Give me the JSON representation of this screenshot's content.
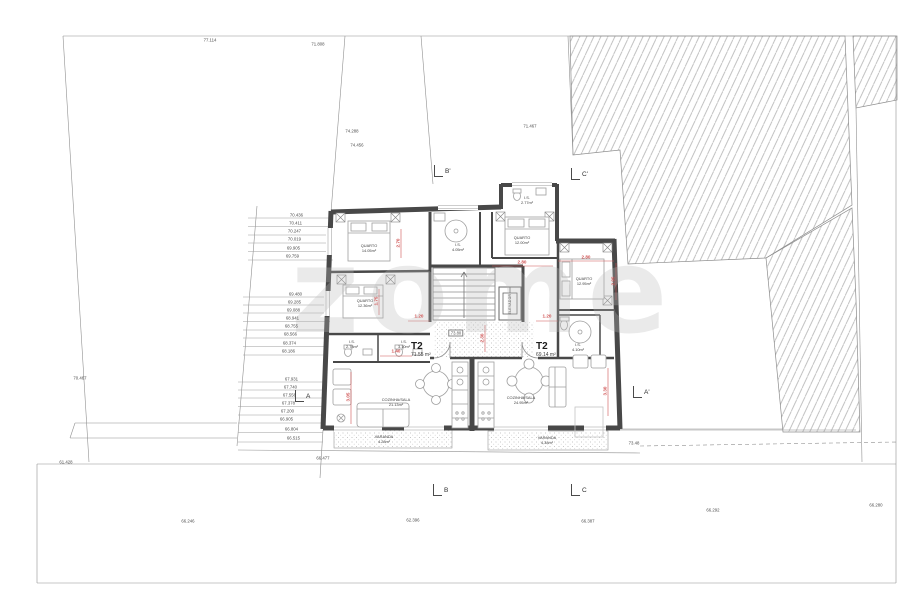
{
  "watermark": "zome",
  "apartments": {
    "left": {
      "type": "T2",
      "area": "71.55 m²",
      "rooms": [
        {
          "name": "QUARTO",
          "area": "14.05m²"
        },
        {
          "name": "QUARTO",
          "area": "12.36m²"
        },
        {
          "name": "I.S.",
          "area": "4.05m²"
        },
        {
          "name": "I.S.",
          "area": "2.78m²"
        },
        {
          "name": "I.S.",
          "area": "3.10m²"
        },
        {
          "name": "COZINHA/SALA",
          "area": "21.13m²"
        },
        {
          "name": "VARANDA",
          "area": "4.28m²"
        }
      ]
    },
    "right": {
      "type": "T2",
      "area": "69.14 m²",
      "rooms": [
        {
          "name": "QUARTO",
          "area": "12.00m²"
        },
        {
          "name": "QUARTO",
          "area": "12.95m²"
        },
        {
          "name": "I.S.",
          "area": "2.77m²"
        },
        {
          "name": "I.S.",
          "area": "4.10m²"
        },
        {
          "name": "COZINHA/SALA",
          "area": "24.95m²"
        },
        {
          "name": "VARANDA",
          "area": "4.38m²"
        }
      ]
    }
  },
  "core": {
    "elevator": "ELEVADOR",
    "hall_level": "73.80"
  },
  "section_markers": [
    {
      "label": "B'",
      "x": 434,
      "y": 165
    },
    {
      "label": "C'",
      "x": 571,
      "y": 168
    },
    {
      "label": "A",
      "x": 295,
      "y": 390
    },
    {
      "label": "A'",
      "x": 633,
      "y": 386
    },
    {
      "label": "B",
      "x": 433,
      "y": 484
    },
    {
      "label": "C",
      "x": 571,
      "y": 484
    }
  ],
  "elevation_labels": [
    {
      "x": 303,
      "y": 215,
      "t": "70.436",
      "r": 1
    },
    {
      "x": 302,
      "y": 223,
      "t": "70.411",
      "r": 1
    },
    {
      "x": 301,
      "y": 231,
      "t": "70.247",
      "r": 1
    },
    {
      "x": 301,
      "y": 239,
      "t": "70.019",
      "r": 1
    },
    {
      "x": 300,
      "y": 248,
      "t": "69.905",
      "r": 1
    },
    {
      "x": 299,
      "y": 256,
      "t": "69.759",
      "r": 1
    },
    {
      "x": 302,
      "y": 294,
      "t": "69.480",
      "r": 1
    },
    {
      "x": 301,
      "y": 302,
      "t": "69.285",
      "r": 1
    },
    {
      "x": 300,
      "y": 310,
      "t": "69.088",
      "r": 1
    },
    {
      "x": 299,
      "y": 318,
      "t": "68.941",
      "r": 1
    },
    {
      "x": 298,
      "y": 326,
      "t": "68.755",
      "r": 1
    },
    {
      "x": 297,
      "y": 334,
      "t": "68.566",
      "r": 1
    },
    {
      "x": 296,
      "y": 343,
      "t": "68.374",
      "r": 1
    },
    {
      "x": 295,
      "y": 351,
      "t": "68.186",
      "r": 1
    },
    {
      "x": 298,
      "y": 379,
      "t": "67.931",
      "r": 1
    },
    {
      "x": 297,
      "y": 387,
      "t": "67.740",
      "r": 1
    },
    {
      "x": 296,
      "y": 395,
      "t": "67.556",
      "r": 1
    },
    {
      "x": 295,
      "y": 403,
      "t": "67.378",
      "r": 1
    },
    {
      "x": 294,
      "y": 411,
      "t": "67.200",
      "r": 1
    },
    {
      "x": 293,
      "y": 419,
      "t": "66.905",
      "r": 1
    },
    {
      "x": 298,
      "y": 429,
      "t": "66.804",
      "r": 1
    },
    {
      "x": 300,
      "y": 438,
      "t": "66.515",
      "r": 1
    },
    {
      "x": 210,
      "y": 40,
      "t": "77.114"
    },
    {
      "x": 318,
      "y": 44,
      "t": "71.808"
    },
    {
      "x": 352,
      "y": 131,
      "t": "74.288"
    },
    {
      "x": 357,
      "y": 145,
      "t": "74.456"
    },
    {
      "x": 530,
      "y": 126,
      "t": "71.467"
    },
    {
      "x": 80,
      "y": 378,
      "t": "70.467"
    },
    {
      "x": 323,
      "y": 458,
      "t": "66.477"
    },
    {
      "x": 66,
      "y": 462,
      "t": "61.428"
    },
    {
      "x": 188,
      "y": 521,
      "t": "66.246"
    },
    {
      "x": 413,
      "y": 520,
      "t": "62.396"
    },
    {
      "x": 588,
      "y": 521,
      "t": "66.387"
    },
    {
      "x": 713,
      "y": 510,
      "t": "66.292"
    },
    {
      "x": 876,
      "y": 505,
      "t": "66.280"
    },
    {
      "x": 634,
      "y": 443,
      "t": "73.48"
    }
  ],
  "red_dimensions": [
    {
      "x": 522,
      "y": 262,
      "t": "2.80"
    },
    {
      "x": 586,
      "y": 257,
      "t": "2.80"
    },
    {
      "x": 398,
      "y": 243,
      "t": "2.70",
      "rot": 1
    },
    {
      "x": 348,
      "y": 397,
      "t": "3.05",
      "rot": 1
    },
    {
      "x": 605,
      "y": 391,
      "t": "3.30",
      "rot": 1
    },
    {
      "x": 482,
      "y": 338,
      "t": "2.30",
      "rot": 1
    },
    {
      "x": 419,
      "y": 316,
      "t": "1.20"
    },
    {
      "x": 547,
      "y": 316,
      "t": "1.20"
    },
    {
      "x": 396,
      "y": 351,
      "t": "1.40"
    },
    {
      "x": 376,
      "y": 301,
      "t": "1.75",
      "rot": 1
    },
    {
      "x": 613,
      "y": 281,
      "t": "2.95",
      "rot": 1
    }
  ],
  "colors": {
    "dimension_red": "#d05454",
    "wall_gray": "#484848",
    "line_gray": "#8c8c8c"
  }
}
